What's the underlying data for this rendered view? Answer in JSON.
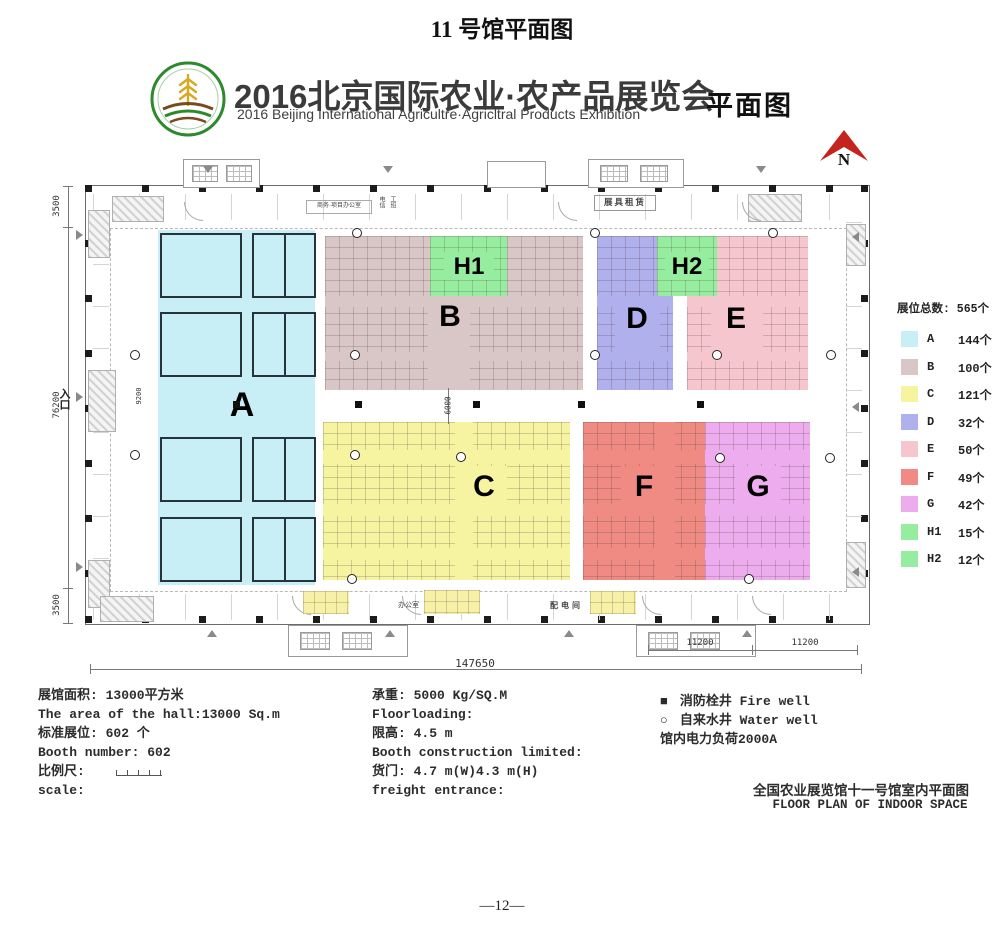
{
  "page": {
    "title": "11 号馆平面图",
    "page_number": "—12—"
  },
  "header": {
    "title_cn": "2016北京国际农业·农产品展览会",
    "title_en": "2016 Beijing International Agricultre·Agricltral Products Exhibition",
    "plan_label": "平面图",
    "north_label": "N"
  },
  "colors": {
    "A": "#c8eef6",
    "B": "#d9c6c6",
    "C": "#f6f4a0",
    "D": "#afb0ec",
    "E": "#f5c6ce",
    "F": "#ef8b83",
    "G": "#edaced",
    "H1": "#96ed9f",
    "H2": "#96ed9f",
    "north": "#c4241d",
    "bay_yellow": "#f7f1a8"
  },
  "plan": {
    "zone_labels": {
      "A": "A",
      "B": "B",
      "C": "C",
      "D": "D",
      "E": "E",
      "F": "F",
      "G": "G",
      "H1": "H1",
      "H2": "H2"
    },
    "entrance": "入口",
    "dimensions": {
      "left_top": "3500",
      "left_middle": "76200",
      "left_bottom": "3500",
      "entry_bay": "9200",
      "center_aisle": "6000",
      "bottom_bay1": "11200",
      "bottom_bay2": "11200",
      "bottom_total": "147650"
    },
    "rooms": {
      "office_suite": "商务·项目办公室",
      "telecom": "电信",
      "work_room": "工班",
      "booth_rental": "展具租赁",
      "office": "办公室",
      "power_room": "配电间"
    }
  },
  "legend": {
    "title": "展位总数: 565个",
    "items": [
      {
        "zone": "A",
        "count": "144个"
      },
      {
        "zone": "B",
        "count": "100个"
      },
      {
        "zone": "C",
        "count": "121个"
      },
      {
        "zone": "D",
        "count": "32个"
      },
      {
        "zone": "E",
        "count": "50个"
      },
      {
        "zone": "F",
        "count": "49个"
      },
      {
        "zone": "G",
        "count": "42个"
      },
      {
        "zone": "H1",
        "count": "15个"
      },
      {
        "zone": "H2",
        "count": "12个"
      }
    ]
  },
  "info": {
    "col1": [
      "展馆面积: 13000平方米",
      "The area of the hall:13000 Sq.m",
      "标准展位: 602 个",
      "Booth number: 602",
      "比例尺:",
      "scale:"
    ],
    "col2": [
      "承重: 5000 Kg/SQ.M",
      "Floorloading:",
      "限高: 4.5 m",
      "Booth construction limited:",
      "货门: 4.7 m(W)4.3 m(H)",
      "freight entrance:"
    ],
    "col3": {
      "fire_symbol": "■",
      "fire_label": "消防栓井 Fire well",
      "water_symbol": "○",
      "water_label": "自来水井 Water well",
      "power_note": "馆内电力负荷2000A"
    }
  },
  "footer": {
    "cn": "全国农业展览馆十一号馆室内平面图",
    "en": "FLOOR PLAN OF INDOOR SPACE"
  }
}
